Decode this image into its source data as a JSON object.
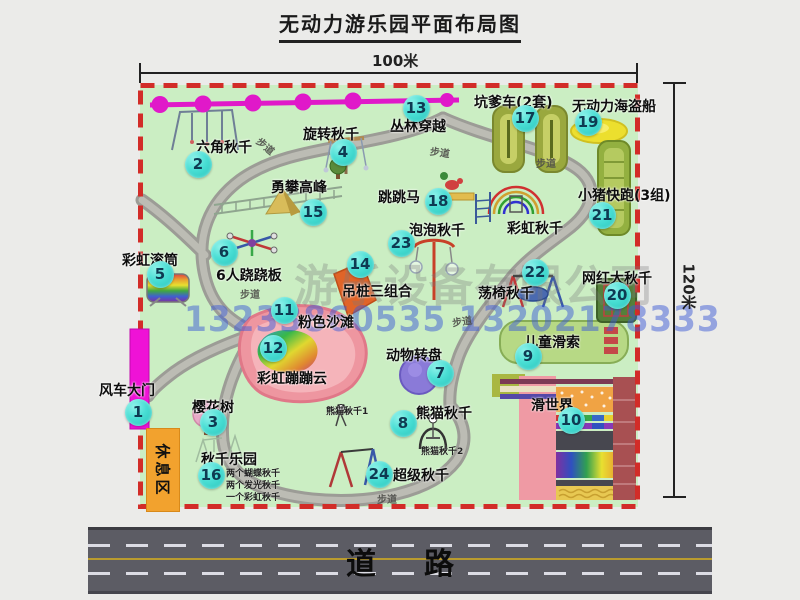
{
  "title": "无动力游乐园平面布局图",
  "dimensions": {
    "top": "100米",
    "right": "120米"
  },
  "road": {
    "label": "道路"
  },
  "rest_area": "休息区",
  "watermark": {
    "company": "游乐设备有限公司",
    "phone": "13233860535 13202178333"
  },
  "colors": {
    "map_bg": "#cbeec3",
    "border_dashed": "#d22c28",
    "badge": "#2fc9c0",
    "gate_magenta": "#ef12d6",
    "zipline_magenta": "#e019c9",
    "rest_area_bg": "#f2a22e",
    "road_asphalt": "#5c5c64",
    "road_center_line": "#b99b2e"
  },
  "map": {
    "attractions": [
      {
        "num": 1,
        "name": "风车大门",
        "label": [
          99,
          380
        ],
        "badge": [
          138,
          412
        ]
      },
      {
        "num": 2,
        "name": "六角秋千",
        "label": [
          196,
          137
        ],
        "badge": [
          198,
          164
        ]
      },
      {
        "num": 3,
        "name": "樱花树",
        "label": [
          192,
          397
        ],
        "badge": [
          213,
          422
        ]
      },
      {
        "num": 4,
        "name": "旋转秋千",
        "label": [
          303,
          124
        ],
        "badge": [
          343,
          152
        ]
      },
      {
        "num": 5,
        "name": "彩虹滚筒",
        "label": [
          122,
          250
        ],
        "badge": [
          160,
          274
        ]
      },
      {
        "num": 6,
        "name": "6人跷跷板",
        "label": [
          216,
          265
        ],
        "badge": [
          224,
          252
        ]
      },
      {
        "num": 7,
        "name": "动物转盘",
        "label": [
          386,
          345
        ],
        "badge": [
          440,
          373
        ]
      },
      {
        "num": 8,
        "name": "熊猫秋千",
        "label": [
          416,
          403
        ],
        "badge": [
          403,
          423
        ]
      },
      {
        "num": 9,
        "name": "儿童滑索",
        "label": [
          524,
          332
        ],
        "badge": [
          528,
          356
        ]
      },
      {
        "num": 10,
        "name": "滑世界",
        "label": [
          531,
          395
        ],
        "badge": [
          571,
          420
        ]
      },
      {
        "num": 11,
        "name": "粉色沙滩",
        "label": [
          298,
          312
        ],
        "badge": [
          284,
          310
        ]
      },
      {
        "num": 12,
        "name": "彩虹蹦蹦云",
        "label": [
          257,
          368
        ],
        "badge": [
          273,
          348
        ]
      },
      {
        "num": 13,
        "name": "丛林穿越",
        "label": [
          390,
          116
        ],
        "badge": [
          416,
          108
        ]
      },
      {
        "num": 14,
        "name": "吊桩三组合",
        "label": [
          342,
          281
        ],
        "badge": [
          360,
          264
        ]
      },
      {
        "num": 15,
        "name": "勇攀高峰",
        "label": [
          271,
          177
        ],
        "badge": [
          313,
          212
        ]
      },
      {
        "num": 16,
        "name": "秋千乐园",
        "label": [
          201,
          449
        ],
        "badge": [
          211,
          475
        ]
      },
      {
        "num": 17,
        "name": "坑爹车(2套)",
        "label": [
          474,
          92
        ],
        "badge": [
          525,
          118
        ]
      },
      {
        "num": 18,
        "name": "跳跳马",
        "label": [
          378,
          187
        ],
        "badge": [
          438,
          201
        ]
      },
      {
        "num": 19,
        "name": "无动力海盗船",
        "label": [
          572,
          96
        ],
        "badge": [
          588,
          122
        ]
      },
      {
        "num": 20,
        "name": "网红大秋千",
        "label": [
          582,
          268
        ],
        "badge": [
          617,
          295
        ]
      },
      {
        "num": 21,
        "name": "小猪快跑(3组)",
        "label": [
          578,
          185
        ],
        "badge": [
          602,
          215
        ]
      },
      {
        "num": 22,
        "name": "荡椅秋千",
        "label": [
          478,
          283
        ],
        "badge": [
          535,
          272
        ]
      },
      {
        "num": 23,
        "name": "泡泡秋千",
        "label": [
          409,
          220
        ],
        "badge": [
          401,
          243
        ]
      },
      {
        "num": 24,
        "name": "超级秋千",
        "label": [
          393,
          465
        ],
        "badge": [
          379,
          474
        ]
      },
      {
        "num": null,
        "name": "彩虹秋千",
        "label": [
          507,
          218
        ],
        "badge": null
      }
    ],
    "small_labels": [
      {
        "text": "熊猫秋千1",
        "pos": [
          326,
          404
        ]
      },
      {
        "text": "熊猫秋千2",
        "pos": [
          421,
          444
        ]
      },
      {
        "text": "两个蝴蝶秋千",
        "pos": [
          226,
          466
        ]
      },
      {
        "text": "两个发光秋千",
        "pos": [
          226,
          478
        ]
      },
      {
        "text": "一个彩虹秋千",
        "pos": [
          226,
          490
        ]
      }
    ],
    "path_labels": [
      {
        "text": "步道",
        "pos": [
          256,
          138
        ],
        "rot": 40
      },
      {
        "text": "步道",
        "pos": [
          430,
          144
        ],
        "rot": 8
      },
      {
        "text": "步道",
        "pos": [
          536,
          155
        ],
        "rot": 0
      },
      {
        "text": "步道",
        "pos": [
          240,
          286
        ],
        "rot": 0
      },
      {
        "text": "步道",
        "pos": [
          452,
          313
        ],
        "rot": -8
      },
      {
        "text": "步道",
        "pos": [
          377,
          491
        ],
        "rot": 0
      }
    ]
  }
}
